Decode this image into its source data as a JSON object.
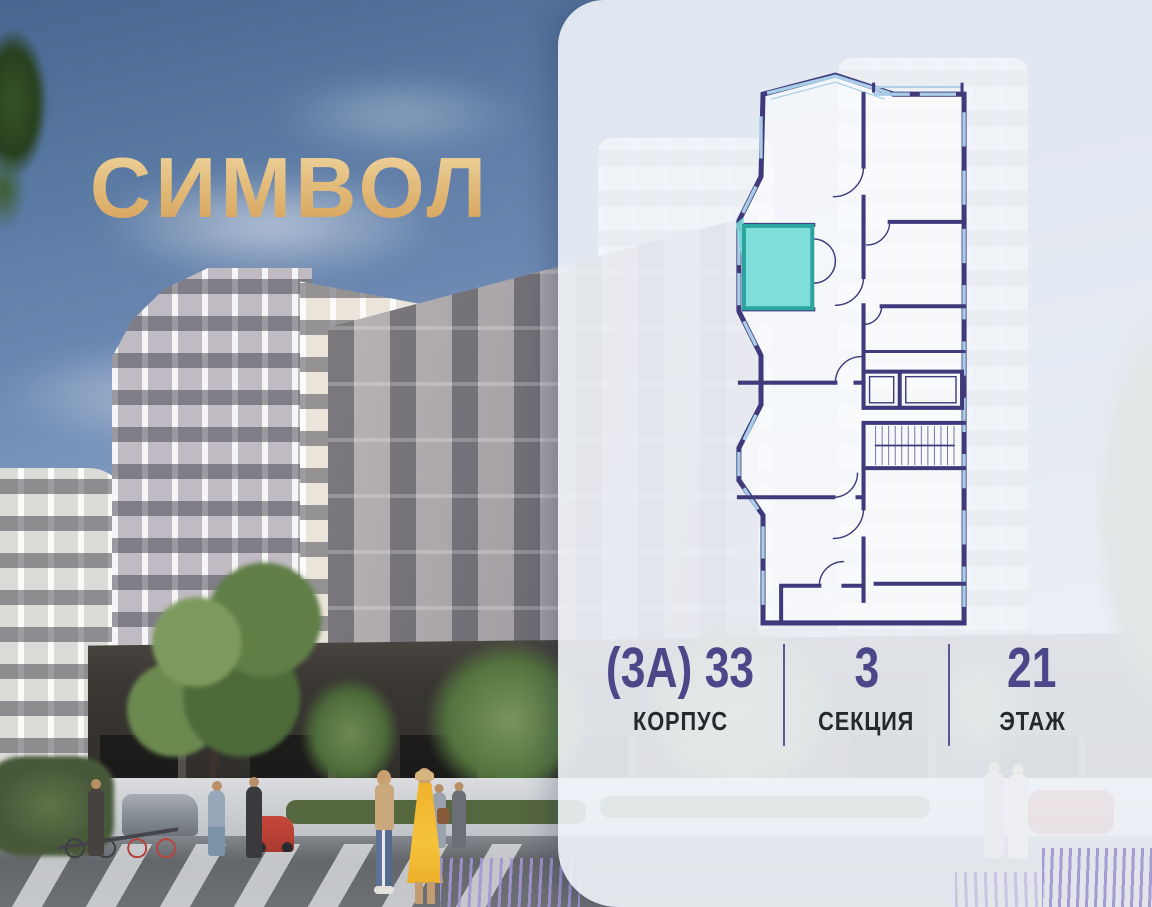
{
  "logo": {
    "text": "СИМВОЛ"
  },
  "info_bar": {
    "items": [
      {
        "value": "(3А) 33",
        "label": "КОРПУС"
      },
      {
        "value": "3",
        "label": "СЕКЦИЯ"
      },
      {
        "value": "21",
        "label": "ЭТАЖ"
      }
    ]
  },
  "colors": {
    "logo_gold": "#ddb371",
    "accent_indigo": "#4c4789",
    "label_dark": "#26282e",
    "panel_bg": "rgba(240,243,248,0.9)",
    "plan_wall": "#3e3a7c",
    "plan_glazing": "#a9cde6",
    "unit_fill": "#7fdeda",
    "unit_border": "#2aa49f"
  }
}
